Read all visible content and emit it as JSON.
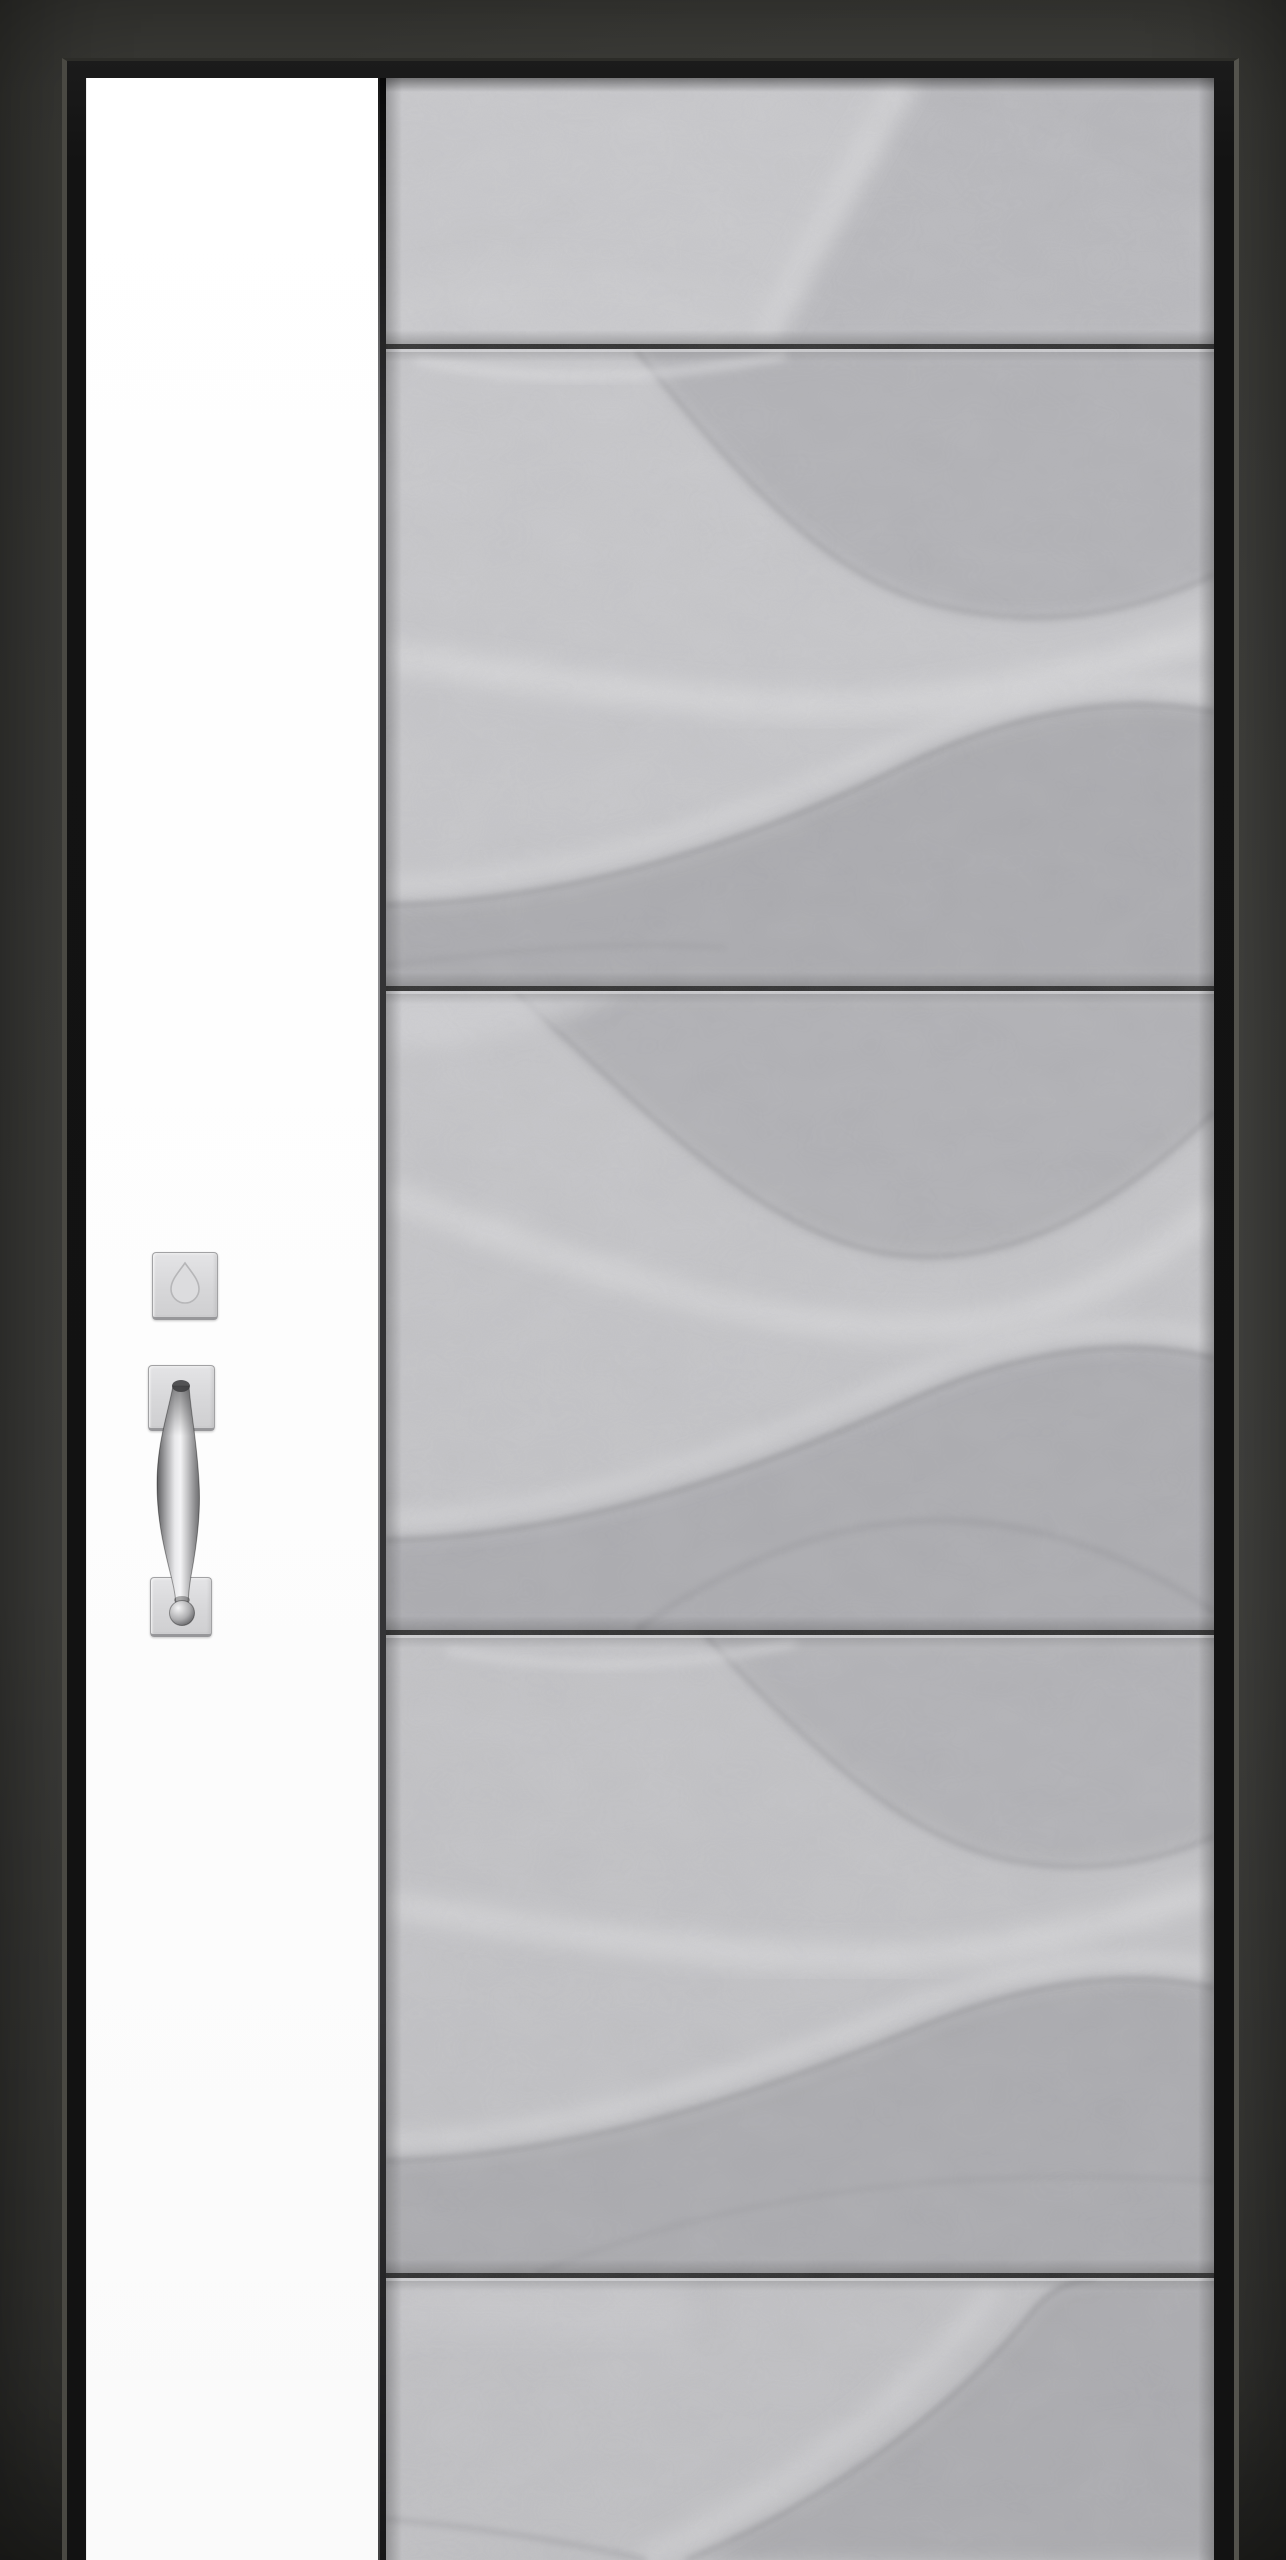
{
  "meta": {
    "description": "Modern entry door with concrete wave-relief slab, white sidelite and satin handleset",
    "canvas": {
      "width": 1286,
      "height": 2560
    }
  },
  "wall": {
    "base_color": "#3c3c39",
    "light_color": "#585854",
    "shadow_color": "#30302d"
  },
  "frame": {
    "color": "#131313",
    "left_edge_highlight": "#4a4943",
    "right_edge_highlight": "#54534d"
  },
  "sidelite": {
    "color": "#ffffff"
  },
  "divider": {
    "light_color": "#8e8e91",
    "dark_color": "#333335"
  },
  "door": {
    "material": "textured concrete with wave relief",
    "base_light": "#cacacd",
    "base_dark": "#c1c1c4",
    "wave_shadow": "#b0b0b4",
    "wave_deep_shadow": "#ababaf",
    "wave_highlight": "#dadadc",
    "contour_color": "#8a8a8e",
    "groove_color": "#2c2c2c",
    "groove_highlight": "#d9d9db",
    "groove_positions_y": [
      344,
      986,
      1630,
      2273
    ],
    "panel_count": 5
  },
  "hardware": {
    "finish_description": "satin nickel",
    "plate_light": "#e4e4e6",
    "plate_dark": "#cfcfd1",
    "plate_border": "#a2a2a4",
    "thumbturn_outline": "#b6b6b8",
    "grip_dark": "#5c5c5e",
    "grip_light": "#f4f4f5",
    "deadbolt_pos": {
      "x": 152,
      "y": 1252,
      "w": 66,
      "h": 68
    },
    "top_plate_pos": {
      "x": 148,
      "y": 1365,
      "w": 67,
      "h": 66
    },
    "bottom_plate_pos": {
      "x": 150,
      "y": 1577,
      "w": 62,
      "h": 60
    }
  }
}
